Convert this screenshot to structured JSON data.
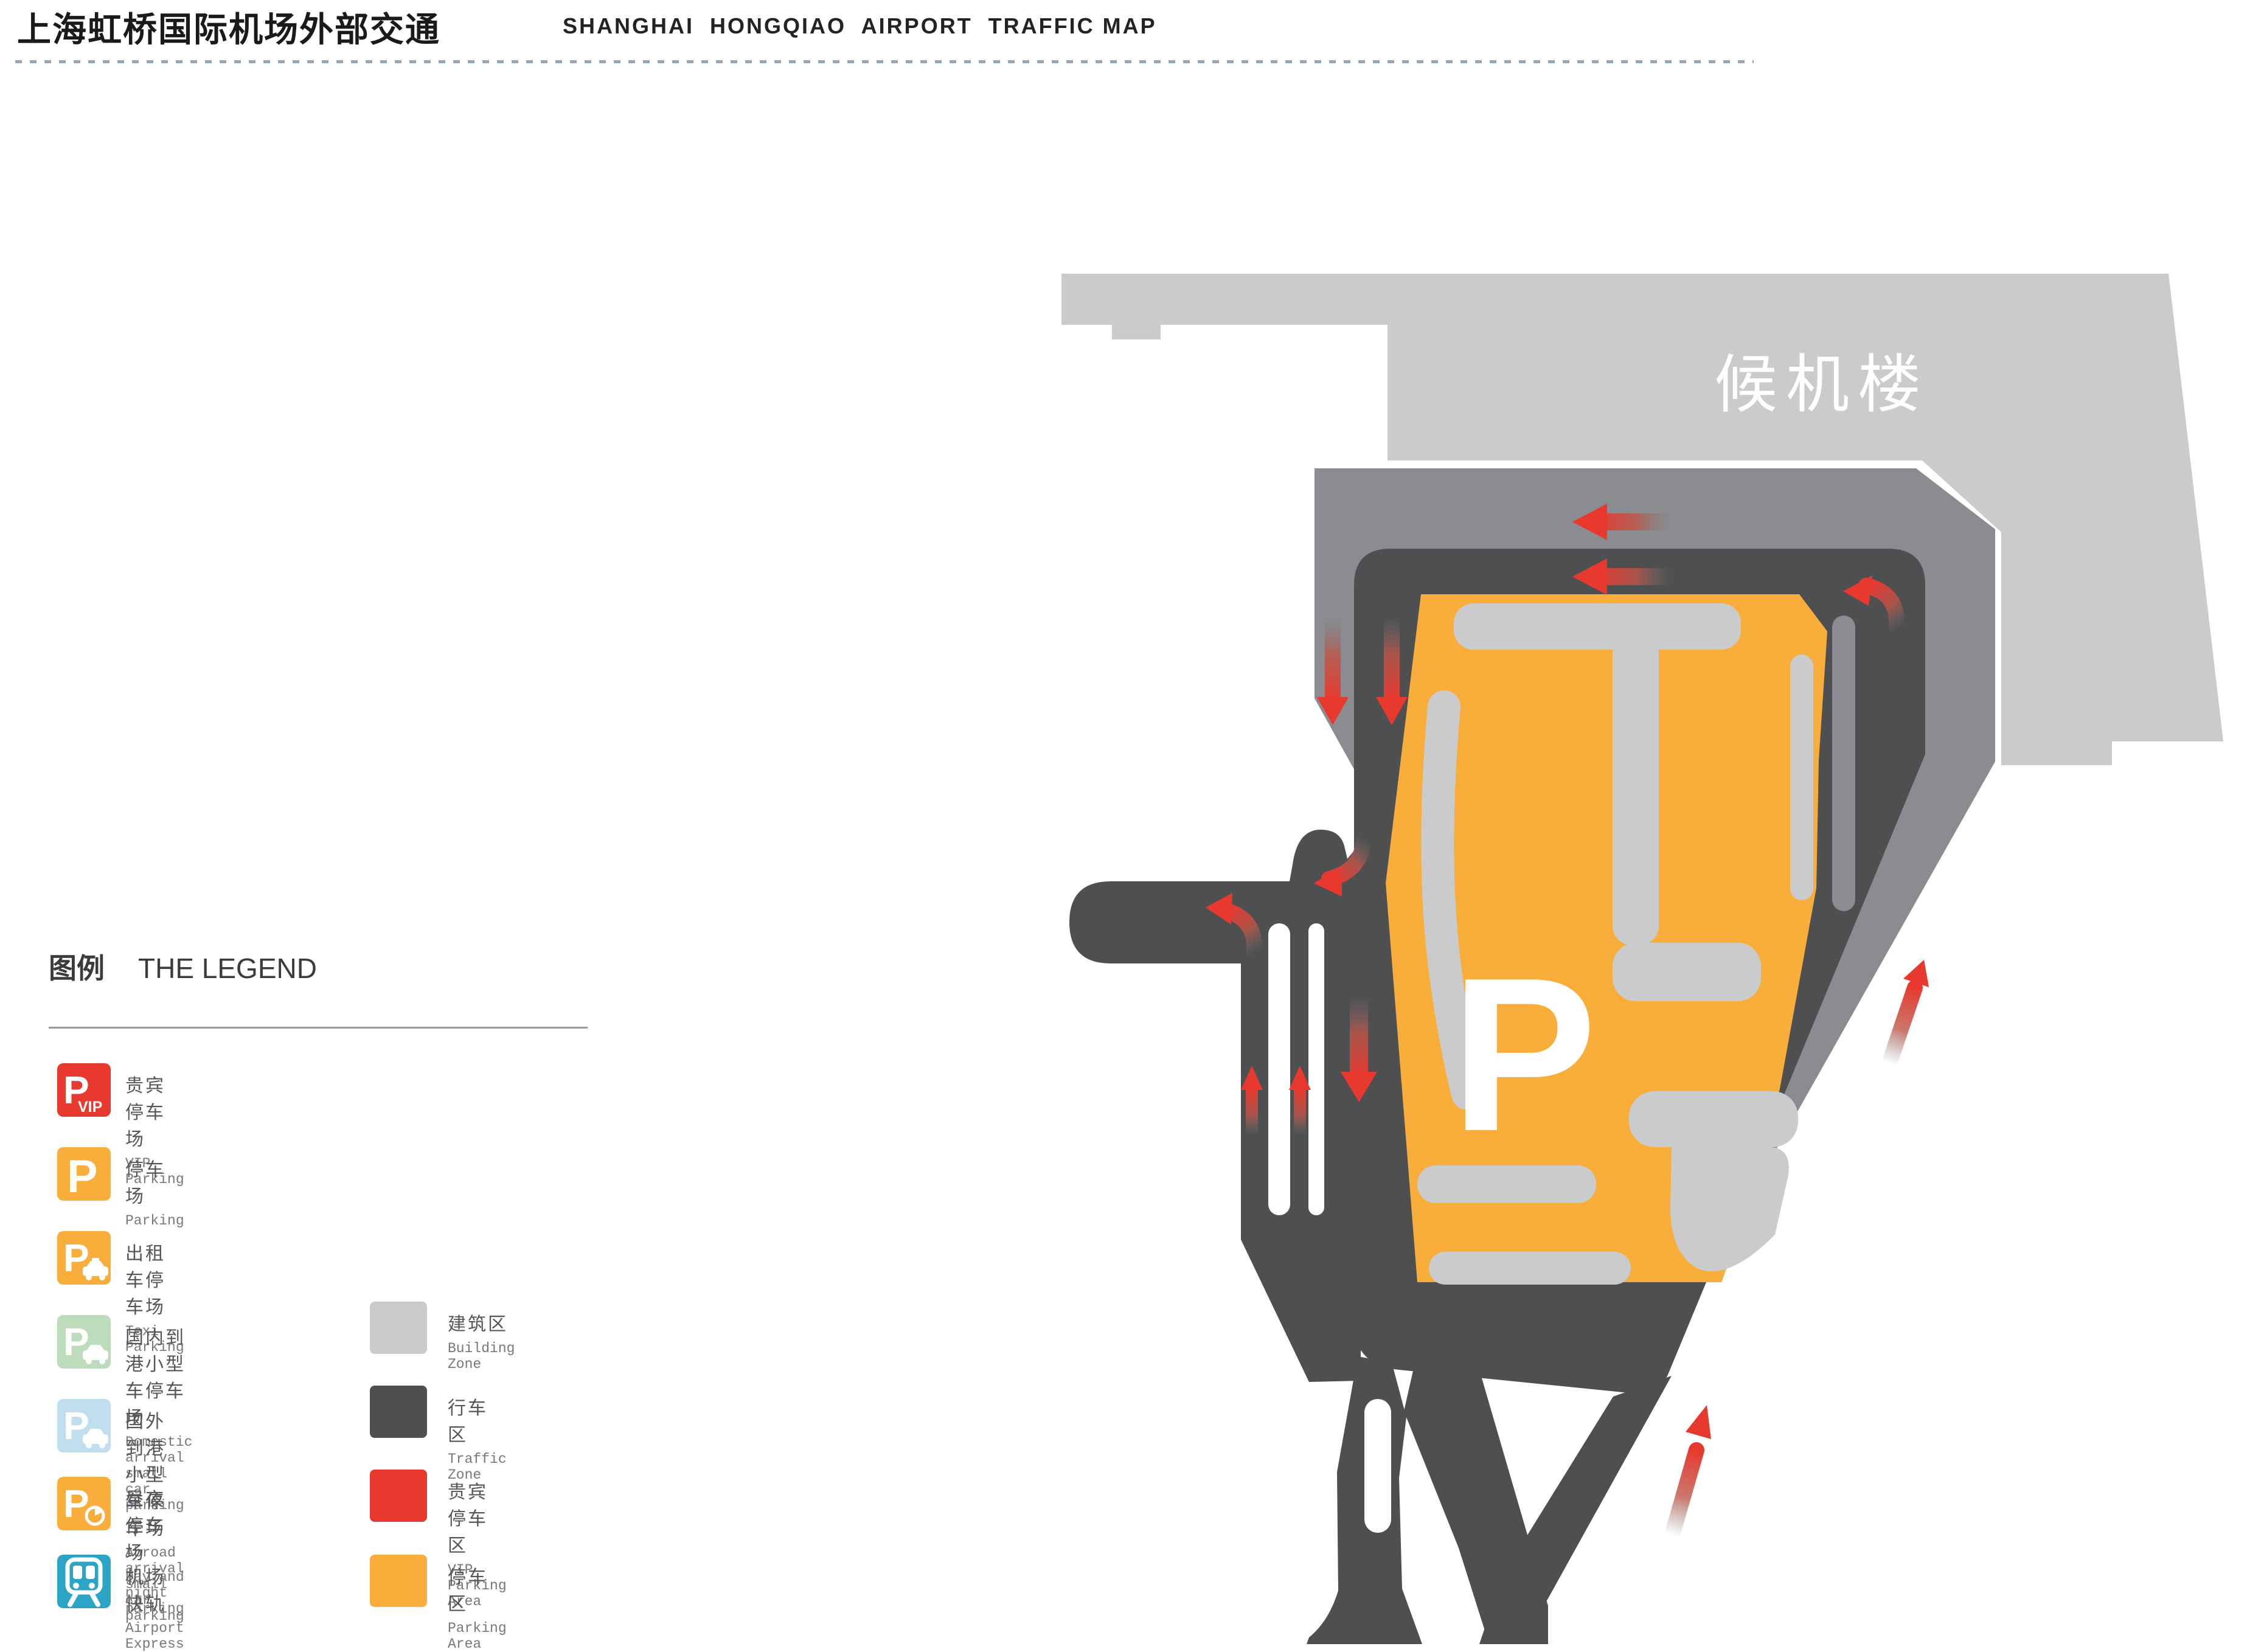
{
  "header": {
    "title_zh": "上海虹桥国际机场外部交通",
    "title_en": "SHANGHAI  HONGQIAO  AIRPORT  TRAFFIC MAP"
  },
  "legend": {
    "heading_zh": "图例",
    "heading_en": "THE LEGEND",
    "items_left": [
      {
        "id": "vip-parking",
        "icon": "p-vip",
        "color": "#E8392F",
        "label_zh": "贵宾停车场",
        "label_en": "VIP  Parking"
      },
      {
        "id": "parking",
        "icon": "p",
        "color": "#F9AE3B",
        "label_zh": "停车场",
        "label_en": "Parking"
      },
      {
        "id": "taxi-parking",
        "icon": "p-taxi",
        "color": "#F9AE3B",
        "label_zh": "出租车停车场",
        "label_en": "Texi Parking"
      },
      {
        "id": "domestic-arrival-parking",
        "icon": "p-car",
        "color": "#BCDCBB",
        "label_zh": "国内到港小型车停车场",
        "label_en": "Domestic arrival small car parking"
      },
      {
        "id": "abroad-arrival-parking",
        "icon": "p-car",
        "color": "#BFDFEF",
        "label_zh": "国外到港小型车停车场",
        "label_en": "Abroad arrival small car parking"
      },
      {
        "id": "day-night-parking",
        "icon": "p-clock",
        "color": "#F9AE3B",
        "label_zh": "昼夜停车场",
        "label_en": "Day and night parking"
      },
      {
        "id": "airport-express",
        "icon": "train",
        "color": "#2BA4C6",
        "label_zh": "机场快轨",
        "label_en": "Airport Express"
      }
    ],
    "items_right": [
      {
        "id": "building-zone",
        "color": "#C9CBCD",
        "label_zh": "建筑区",
        "label_en": "Building Zone"
      },
      {
        "id": "traffic-zone",
        "color": "#4E4F51",
        "label_zh": "行车区",
        "label_en": "Traffic Zone"
      },
      {
        "id": "vip-parking-area",
        "color": "#E8392F",
        "label_zh": "贵宾停车区",
        "label_en": "VIP  Parking Area"
      },
      {
        "id": "parking-area",
        "color": "#F9AE3B",
        "label_zh": "停车区",
        "label_en": "Parking Area"
      }
    ]
  },
  "map": {
    "terminal_label": "候机楼",
    "parking_label": "P"
  },
  "colors": {
    "building": "#C9CBCD",
    "band": "#8A8C8F",
    "road": "#4E4F51",
    "parking": "#F9AE3B",
    "vip": "#E8392F",
    "arrow": "#E8392F",
    "dotline": "#8CA9BE"
  }
}
